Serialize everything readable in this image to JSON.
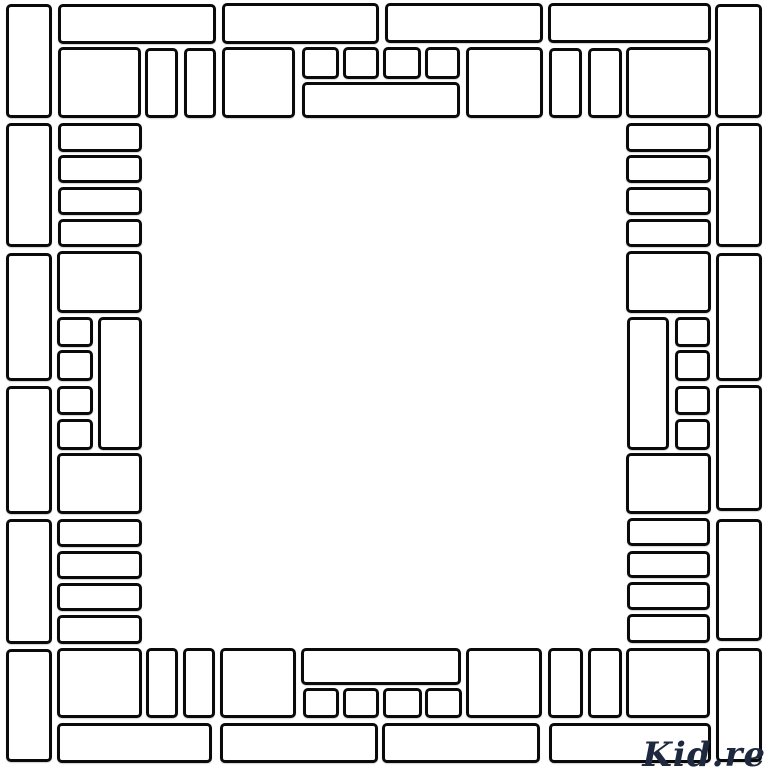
{
  "canvas": {
    "width": 768,
    "height": 768,
    "background": "#ffffff"
  },
  "style": {
    "stroke_color": "#0a0a0a",
    "fill_color": "#ffffff",
    "stroke_width_px": 3,
    "corner_radius_px": 5
  },
  "watermark": {
    "text": "Kid.re",
    "color": "#1e2940"
  },
  "frame": {
    "description": "Decorative square coloring-page frame built from white rounded rectangles with black outlines surrounding an empty white center",
    "tile_groups": {
      "top_border": [
        [
          6,
          4,
          46,
          114
        ],
        [
          58,
          4,
          158,
          40
        ],
        [
          222,
          3,
          157,
          41
        ],
        [
          385,
          3,
          158,
          40
        ],
        [
          548,
          3,
          163,
          40
        ],
        [
          715,
          4,
          47,
          114
        ],
        [
          58,
          47,
          83,
          71
        ],
        [
          145,
          48,
          33,
          70
        ],
        [
          184,
          48,
          32,
          70
        ],
        [
          222,
          47,
          73,
          71
        ],
        [
          302,
          47,
          37,
          32
        ],
        [
          343,
          47,
          36,
          32
        ],
        [
          383,
          47,
          38,
          32
        ],
        [
          425,
          47,
          35,
          32
        ],
        [
          302,
          82,
          158,
          36
        ],
        [
          466,
          47,
          77,
          71
        ],
        [
          549,
          48,
          33,
          70
        ],
        [
          588,
          48,
          34,
          70
        ],
        [
          626,
          47,
          85,
          71
        ]
      ],
      "left_border_outer": [
        [
          6,
          123,
          46,
          124
        ],
        [
          6,
          253,
          46,
          128
        ],
        [
          6,
          386,
          46,
          128
        ],
        [
          6,
          519,
          46,
          125
        ],
        [
          6,
          649,
          46,
          113
        ]
      ],
      "left_border_inner": [
        [
          58,
          123,
          84,
          29
        ],
        [
          58,
          155,
          84,
          28
        ],
        [
          58,
          187,
          84,
          28
        ],
        [
          58,
          219,
          84,
          28
        ],
        [
          57,
          251,
          85,
          62
        ],
        [
          57,
          317,
          36,
          30
        ],
        [
          57,
          350,
          36,
          31
        ],
        [
          57,
          386,
          36,
          29
        ],
        [
          57,
          419,
          36,
          31
        ],
        [
          98,
          317,
          44,
          133
        ],
        [
          57,
          453,
          85,
          61
        ],
        [
          57,
          519,
          85,
          28
        ],
        [
          57,
          551,
          85,
          28
        ],
        [
          57,
          583,
          85,
          28
        ],
        [
          57,
          615,
          85,
          29
        ]
      ],
      "right_border_outer": [
        [
          716,
          123,
          46,
          124
        ],
        [
          716,
          253,
          46,
          128
        ],
        [
          716,
          385,
          46,
          126
        ],
        [
          716,
          519,
          46,
          122
        ],
        [
          716,
          648,
          46,
          114
        ]
      ],
      "right_border_inner": [
        [
          626,
          123,
          85,
          29
        ],
        [
          626,
          155,
          85,
          28
        ],
        [
          626,
          187,
          85,
          28
        ],
        [
          626,
          219,
          85,
          28
        ],
        [
          626,
          251,
          85,
          62
        ],
        [
          627,
          317,
          42,
          133
        ],
        [
          675,
          317,
          35,
          30
        ],
        [
          675,
          350,
          35,
          31
        ],
        [
          675,
          386,
          35,
          29
        ],
        [
          675,
          419,
          35,
          31
        ],
        [
          626,
          453,
          85,
          61
        ],
        [
          627,
          518,
          83,
          28
        ],
        [
          627,
          551,
          83,
          27
        ],
        [
          627,
          582,
          83,
          28
        ],
        [
          627,
          614,
          83,
          29
        ]
      ],
      "bottom_border": [
        [
          57,
          648,
          85,
          70
        ],
        [
          146,
          648,
          32,
          70
        ],
        [
          183,
          648,
          32,
          70
        ],
        [
          220,
          648,
          76,
          70
        ],
        [
          301,
          648,
          160,
          37
        ],
        [
          303,
          688,
          36,
          30
        ],
        [
          343,
          688,
          36,
          30
        ],
        [
          383,
          688,
          39,
          30
        ],
        [
          425,
          688,
          37,
          30
        ],
        [
          466,
          648,
          76,
          70
        ],
        [
          548,
          648,
          35,
          70
        ],
        [
          588,
          648,
          34,
          70
        ],
        [
          626,
          648,
          84,
          70
        ],
        [
          57,
          723,
          155,
          40
        ],
        [
          220,
          723,
          158,
          40
        ],
        [
          382,
          723,
          158,
          40
        ],
        [
          549,
          723,
          162,
          40
        ]
      ]
    }
  }
}
